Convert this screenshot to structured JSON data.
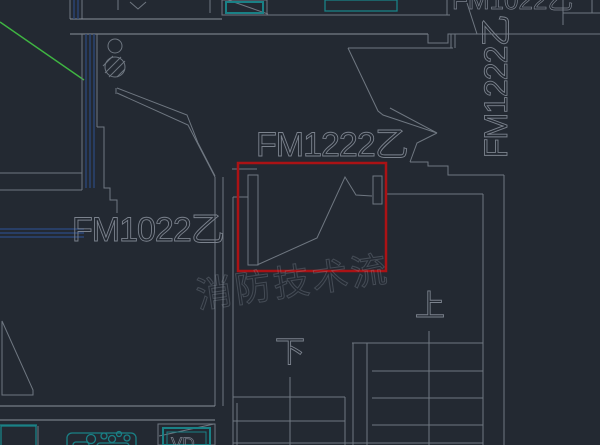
{
  "canvas": {
    "description": "CAD floor plan with fire-door labels and red highlight box"
  },
  "colors": {
    "background": "#232932",
    "line_gray": "#6f7781",
    "line_bright": "#8a919b",
    "wall_navy": "#2b4677",
    "fixture_teal": "#1a8186",
    "teal_dark": "#16595e",
    "reference_green": "#3fb542",
    "highlight_red": "#ab1215",
    "text_gray": "#7b828d",
    "watermark_gray": "#9aa4b0"
  },
  "labels": {
    "door_center": "FM1222乙",
    "door_left": "FM1022乙",
    "door_right_vertical": "FM1222乙",
    "door_top_partial": "FM1022乙",
    "stair_up": "上",
    "stair_down": "下",
    "vd_box": "VD",
    "watermark": "消防技术流"
  }
}
